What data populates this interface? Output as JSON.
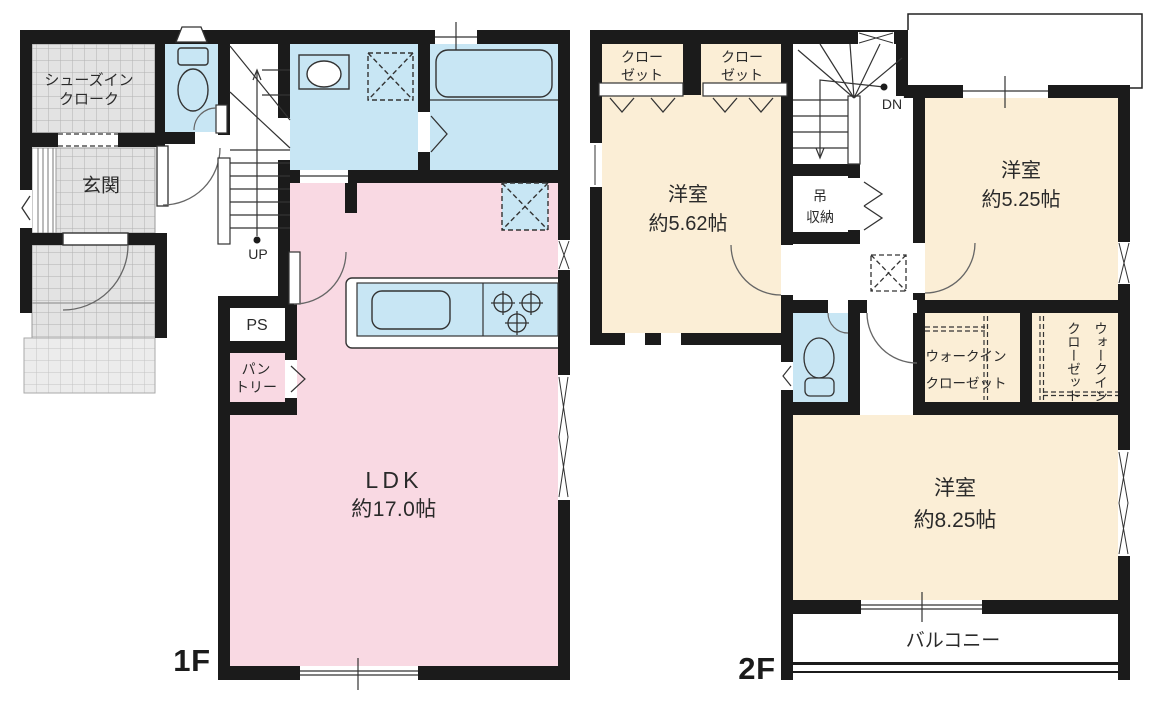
{
  "title": "間取り図",
  "colors": {
    "wall": "#1b1b1b",
    "ldk_pink": "#f9d9e3",
    "wet_blue": "#c8e6f4",
    "room_cream": "#fbeed6",
    "tile_gray": "#e3e3e3",
    "line": "#333333"
  },
  "floors": {
    "f1": {
      "label": "1F",
      "rooms": {
        "shoes_closet": {
          "line1": "シューズイン",
          "line2": "クローク"
        },
        "entrance": {
          "label": "玄関"
        },
        "stairs": {
          "label": "UP"
        },
        "pipe_space": {
          "label": "PS"
        },
        "pantry": {
          "line1": "パン",
          "line2": "トリー"
        },
        "ldk": {
          "name": "LDK",
          "area": "約17.0帖"
        }
      }
    },
    "f2": {
      "label": "2F",
      "rooms": {
        "closet_left": {
          "line1": "クロー",
          "line2": "ゼット"
        },
        "closet_right": {
          "line1": "クロー",
          "line2": "ゼット"
        },
        "stairs": {
          "label": "DN"
        },
        "hanging_storage": {
          "line1": "吊",
          "line2": "収納"
        },
        "bedroom_562": {
          "name": "洋室",
          "area": "約5.62帖"
        },
        "bedroom_525": {
          "name": "洋室",
          "area": "約5.25帖"
        },
        "wic_left": {
          "line1": "ウォークイン",
          "line2": "クローゼット"
        },
        "wic_right": {
          "line1": "ウォークイン",
          "line2": "クローゼット"
        },
        "bedroom_825": {
          "name": "洋室",
          "area": "約8.25帖"
        },
        "balcony": {
          "label": "バルコニー"
        }
      }
    }
  }
}
